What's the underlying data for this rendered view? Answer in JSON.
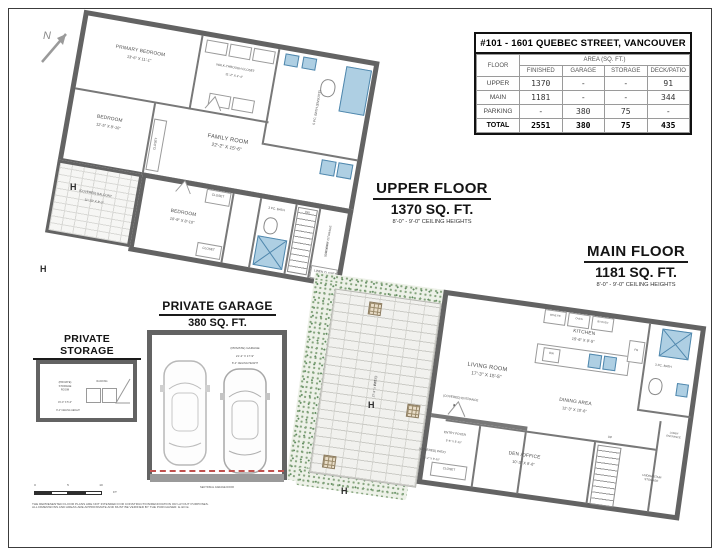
{
  "colors": {
    "wall": "#666666",
    "fixture_blue": "#aecfe3",
    "fixture_blue_dark": "#4f87ad",
    "greenery": "#85a47d",
    "brick": "#f1f1ee",
    "garage_door_red": "#c0504d"
  },
  "compass": {
    "label": "N"
  },
  "area_table": {
    "title": "#101 - 1601 QUEBEC STREET, VANCOUVER",
    "floor_header": "FLOOR",
    "area_header": "AREA (SQ. FT.)",
    "columns": [
      "FINISHED",
      "GARAGE",
      "STORAGE",
      "DECK/PATIO"
    ],
    "rows": [
      {
        "label": "UPPER",
        "finished": "1370",
        "garage": "-",
        "storage": "-",
        "deck": "91"
      },
      {
        "label": "MAIN",
        "finished": "1181",
        "garage": "-",
        "storage": "-",
        "deck": "344"
      },
      {
        "label": "PARKING",
        "finished": "-",
        "garage": "380",
        "storage": "75",
        "deck": "-"
      },
      {
        "label": "TOTAL",
        "finished": "2551",
        "garage": "380",
        "storage": "75",
        "deck": "435"
      }
    ]
  },
  "upper_floor": {
    "title": "UPPER FLOOR",
    "area": "1370 SQ. FT.",
    "ceiling": "8'-0\" - 9'-0\" CEILING HEIGHTS",
    "rooms": {
      "primary_bedroom": {
        "name": "PRIMARY BEDROOM",
        "dims": "13'-6\" X 11'-1\""
      },
      "walk_through_closet": {
        "name": "WALK-THROUGH CLOSET",
        "dims": "11'-2\" X 4'-4\""
      },
      "ensuite_bath": {
        "name": "5 PC. BATH (ENSUITE)"
      },
      "bedroom_2": {
        "name": "BEDROOM",
        "dims": "12'-5\" X 8'-10\""
      },
      "family_room": {
        "name": "FAMILY ROOM",
        "dims": "22'-2\" X 15'-6\""
      },
      "covered_balcony": {
        "name": "(COVERED) BALCONY",
        "dims": "11'-10\" X 8'-2\""
      },
      "bedroom_3": {
        "name": "BEDROOM",
        "dims": "10'-9\" X 8'-10\""
      },
      "bath": {
        "name": "3 PC. BATH"
      },
      "laundry_storage": {
        "name": "LAUNDRY /STORAGE",
        "dims": "10'-0\" X 5'-6\""
      },
      "linen_closet": "LINEN CLOSET",
      "closet": "CLOSET",
      "stair_direction": "DN"
    }
  },
  "main_floor": {
    "title": "MAIN FLOOR",
    "area": "1181 SQ. FT.",
    "ceiling": "8'-0\" - 9'-0\" CEILING HEIGHTS",
    "rooms": {
      "living_room": {
        "name": "LIVING ROOM",
        "dims": "17'-3\" X 15'-5\""
      },
      "kitchen": {
        "name": "KITCHEN",
        "dims": "15'-6\" X 9'-5\""
      },
      "dining_area": {
        "name": "DINING AREA",
        "dims": "12'-3\" X 10'-6\""
      },
      "den_office": {
        "name": "DEN /OFFICE",
        "dims": "10'-3\" X 9'-6\""
      },
      "entry_foyer": {
        "name": "ENTRY FOYER",
        "dims": "5'-5\" X 5'-10\""
      },
      "bath": {
        "name": "3 PC. BATH"
      },
      "under_stair_storage": "UNDER STAIR STORAGE",
      "lobby_entrance": "LOBBY ENTRANCE",
      "closet": "CLOSET",
      "covered_entrance": "(COVERED) ENTRANCE",
      "covered_patio": {
        "name": "(COVERED) PATIO",
        "dims": "12'-2\" X 8'-10\""
      },
      "patio": {
        "name": "PATIO",
        "dims": "27'-9\" X 9'-7\""
      },
      "stair_direction": "UP",
      "appliances": {
        "wine_fridge": "WINE FR",
        "oven": "OVEN",
        "built_in_oven": "B/I OVEN",
        "dishwasher": "DW",
        "fridge": "FR"
      }
    }
  },
  "garage": {
    "title": "PRIVATE GARAGE",
    "area": "380 SQ. FT.",
    "room": "(PRIVATE) GARAGE",
    "dims": "21'-2\" X 17'-9\"",
    "ceiling": "8'-2\" CEILING HEIGHT",
    "door": "SECTIONAL GARAGE DOOR"
  },
  "storage": {
    "title": "PRIVATE STORAGE",
    "area": "75 SQ. FT.",
    "room": "(PRIVATE) STORAGE ROOM",
    "dims": "15'-0\" X 5'-0\"",
    "ceiling": "8'-2\" CEILING HEIGHT",
    "racking": "RACKING"
  },
  "markers": {
    "hose_bib": "H"
  },
  "scale_bar": {
    "ticks": [
      "0",
      "5",
      "10"
    ],
    "unit": "FT"
  },
  "disclaimer": [
    "THE REPRESENTED FLOOR PLANS ARE NOT INTENDED FOR CONSTRUCTION/RENOVATION OR LAYOUT PURPOSES.",
    "ALL DIMENSIONS AND AREAS ARE APPROXIMATE AND MUST BE VERIFIED BY THE PURCHASER. E.&O.E."
  ]
}
